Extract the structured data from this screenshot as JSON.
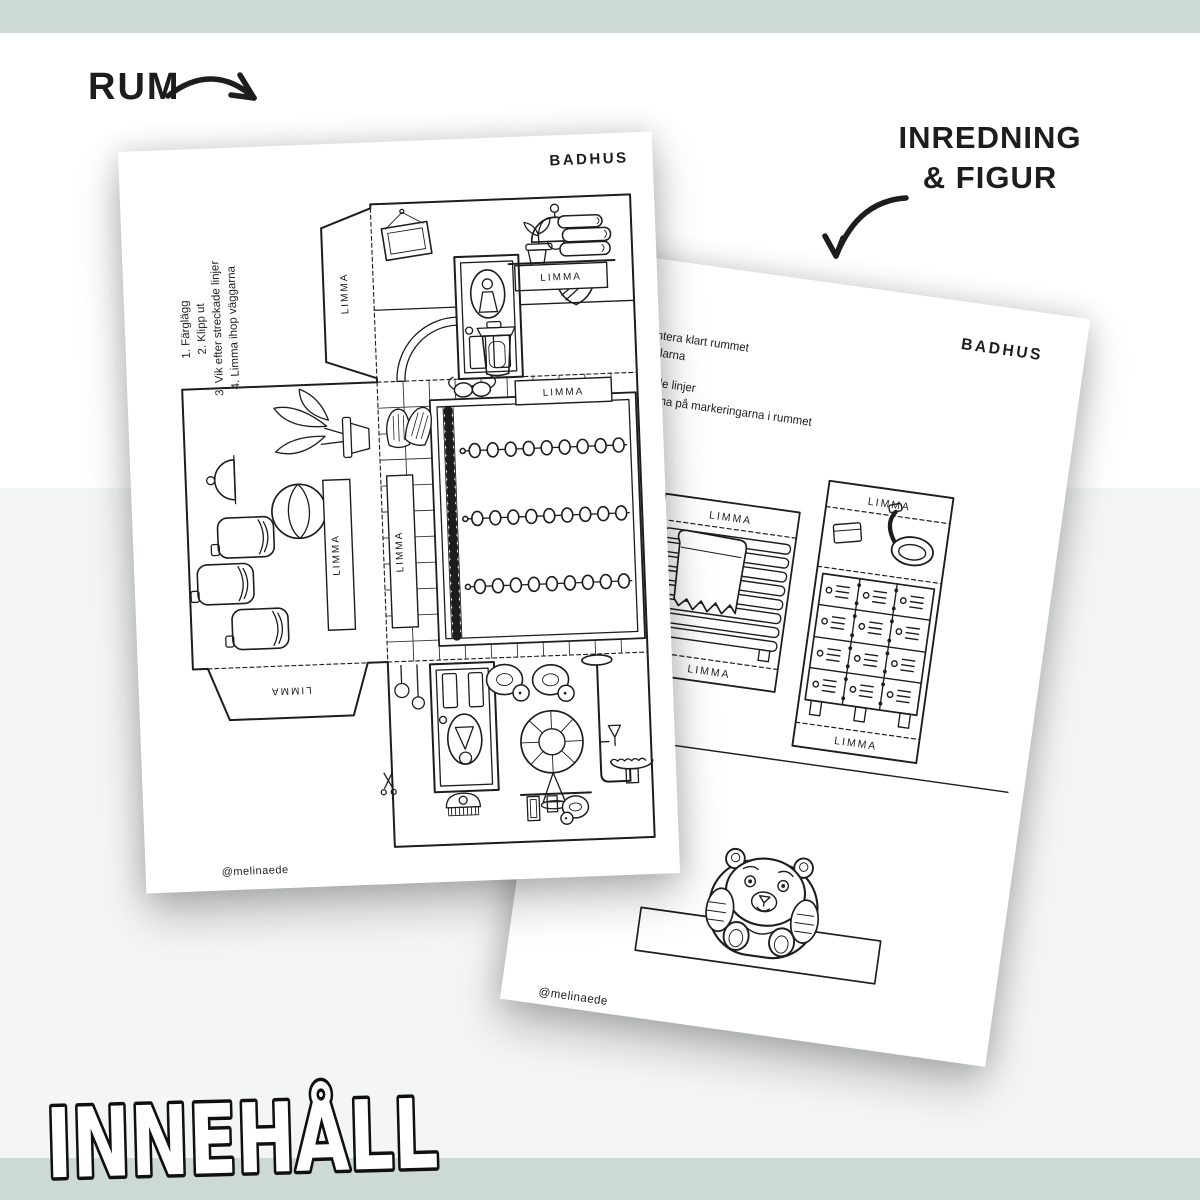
{
  "colors": {
    "band_green": "#ccd9d5",
    "band_gray": "#f4f6f5",
    "paper": "#ffffff",
    "ink": "#1d1d1d"
  },
  "annotations": {
    "rum_label": "RUM",
    "inredning_line1": "INREDNING",
    "inredning_line2": "& FIGUR",
    "innehall_title": "INNEHÅLL"
  },
  "room_page": {
    "title": "BADHUS",
    "instructions": [
      "1. Färglägg",
      "2. Klipp ut",
      "3. Vik efter streckade linjer",
      "4. Limma ihop väggarna"
    ],
    "glue_label": "LIMMA",
    "watermark": "@melinaede"
  },
  "furniture_page": {
    "title": "BADHUS",
    "instruction_fragments": [
      "h montera klart rummet",
      "3D-delarna",
      "treckade linjer",
      "st delarna på markeringarna i rummet"
    ],
    "strip_fragment": "å remsan",
    "glue_label": "LIMMA",
    "watermark": "@melinaede"
  }
}
